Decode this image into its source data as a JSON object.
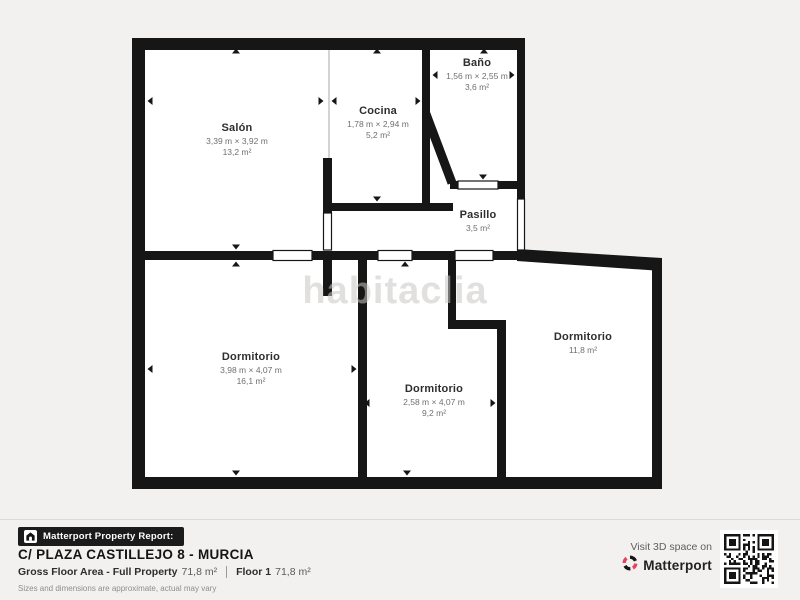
{
  "plan": {
    "watermark": "habitaclia",
    "rooms": [
      {
        "name": "Salón",
        "dims": "3,39 m × 3,92 m",
        "area": "13,2 m²"
      },
      {
        "name": "Cocina",
        "dims": "1,78 m × 2,94 m",
        "area": "5,2 m²"
      },
      {
        "name": "Baño",
        "dims": "1,56 m × 2,55 m",
        "area": "3,6 m²"
      },
      {
        "name": "Pasillo",
        "dims": "",
        "area": "3,5 m²"
      },
      {
        "name": "Dormitorio",
        "dims": "3,98 m × 4,07 m",
        "area": "16,1 m²"
      },
      {
        "name": "Dormitorio",
        "dims": "2,58 m × 4,07 m",
        "area": "9,2 m²"
      },
      {
        "name": "Dormitorio",
        "dims": "",
        "area": "11,8 m²"
      }
    ]
  },
  "footer": {
    "report_label": "Matterport Property Report:",
    "address": "C/ PLAZA CASTILLEJO 8 - MURCIA",
    "gross_label": "Gross Floor Area - Full Property",
    "gross_value": "71,8 m²",
    "floor_label": "Floor 1",
    "floor_value": "71,8 m²",
    "disclaimer": "Sizes and dimensions are approximate, actual may vary",
    "visit_label": "Visit 3D space on",
    "brand": "Matterport"
  },
  "colors": {
    "background": "#f2f1ef",
    "floor": "#ffffff",
    "walls": "#161616",
    "accent": "#e5435c"
  }
}
